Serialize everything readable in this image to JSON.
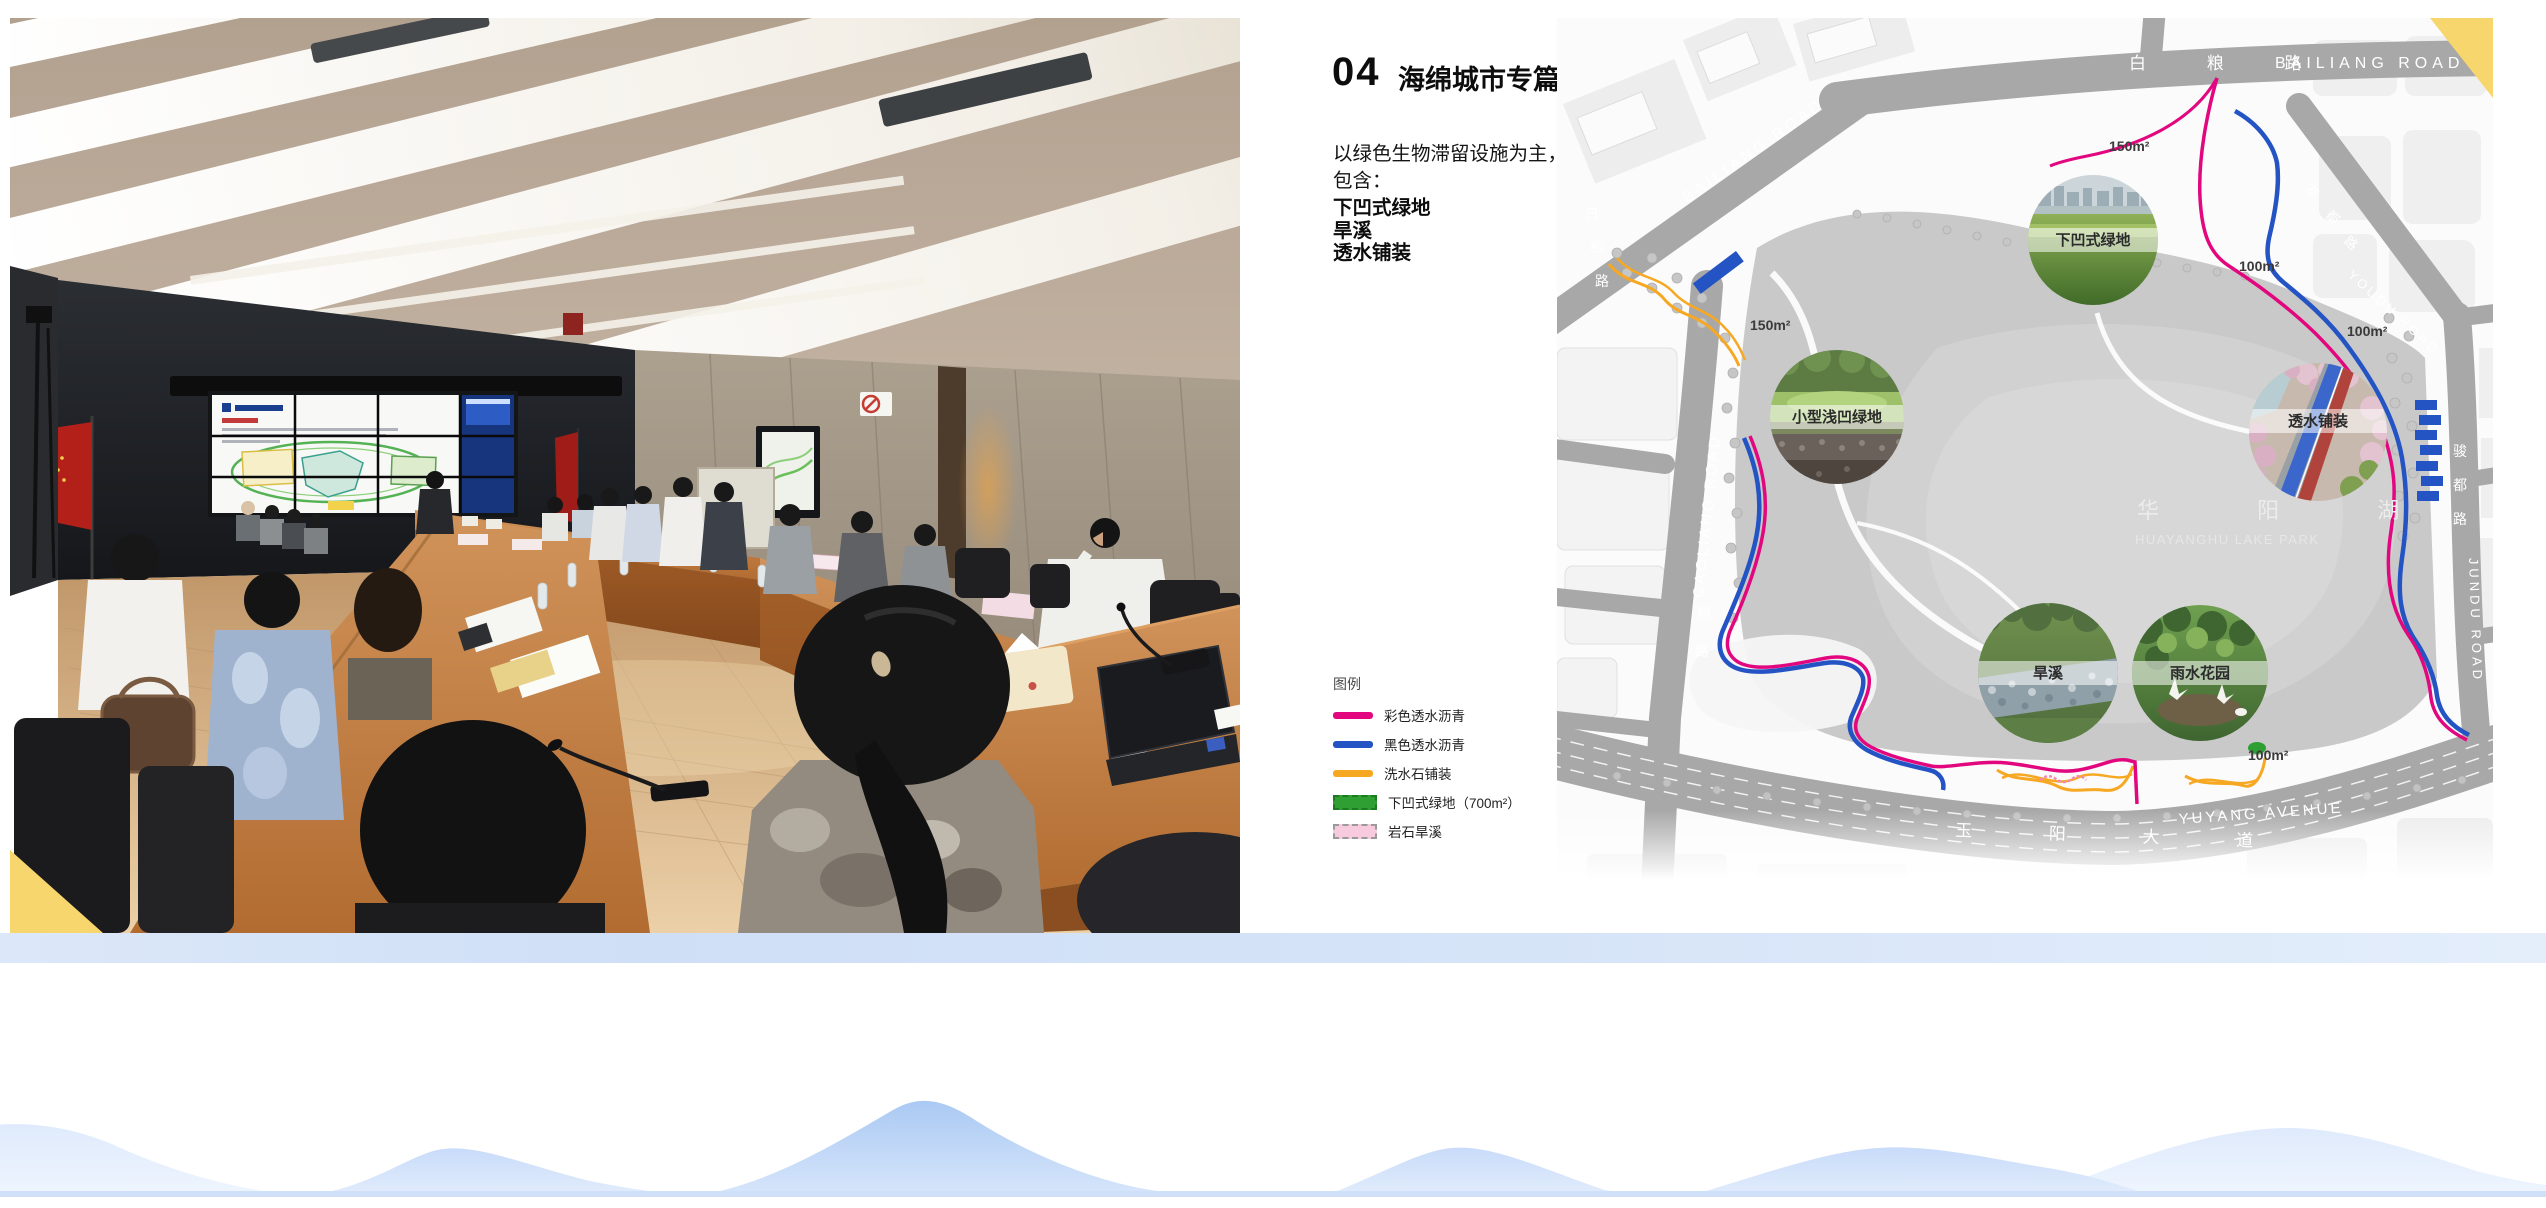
{
  "page": {
    "section_number": "04",
    "section_title": "海绵城市专篇",
    "intro_line1": "以绿色生物滞留设施为主，",
    "intro_line2": "包含：",
    "features": [
      "下凹式绿地",
      "旱溪",
      "透水铺装"
    ],
    "accent_yellow": "#f8d66e"
  },
  "legend": {
    "title": "图例",
    "items": [
      {
        "label": "彩色透水沥青",
        "color": "#e2077e",
        "style": "line"
      },
      {
        "label": "黑色透水沥青",
        "color": "#2453c4",
        "style": "line"
      },
      {
        "label": "洗水石铺装",
        "color": "#f7a823",
        "style": "line"
      },
      {
        "label": "下凹式绿地（700m²）",
        "color": "#2f9e33",
        "style": "dashed-block"
      },
      {
        "label": "岩石旱溪",
        "color": "#f7cade",
        "style": "dashed-block"
      }
    ]
  },
  "map": {
    "road_labels": {
      "bailiang_top_cn": "白 粮 路",
      "bailiang_top_en": "BAILIANG ROAD",
      "bailiang_diag_en": "BAILIANG ROAD",
      "bailiang_diag_cn_chars": [
        "白",
        "粮",
        "路"
      ],
      "caoliang_en": "CAOLIANG ROAD",
      "caoliang_cn_chars": [
        "粮",
        "路"
      ],
      "youdu_cn_chars": [
        "友",
        "都",
        "路"
      ],
      "youdu_en": "YOUDU ROAD",
      "jundu_cn_chars": [
        "骏",
        "都",
        "路"
      ],
      "jundu_en": "JUNDU ROAD",
      "yuyang_cn": "玉 阳 大 道",
      "yuyang_en": "YUYANG AVENUE"
    },
    "lake": {
      "cn": "华 阳 湖",
      "en": "HUAYANGHU LAKE PARK"
    },
    "area_labels": [
      {
        "text": "150m²"
      },
      {
        "text": "150m²"
      },
      {
        "text": "100m²"
      },
      {
        "text": "100m²"
      },
      {
        "text": "100m²"
      }
    ],
    "insets": [
      {
        "label": "下凹式绿地"
      },
      {
        "label": "小型浅凹绿地"
      },
      {
        "label": "透水铺装"
      },
      {
        "label": "旱溪"
      },
      {
        "label": "雨水花园"
      }
    ]
  }
}
